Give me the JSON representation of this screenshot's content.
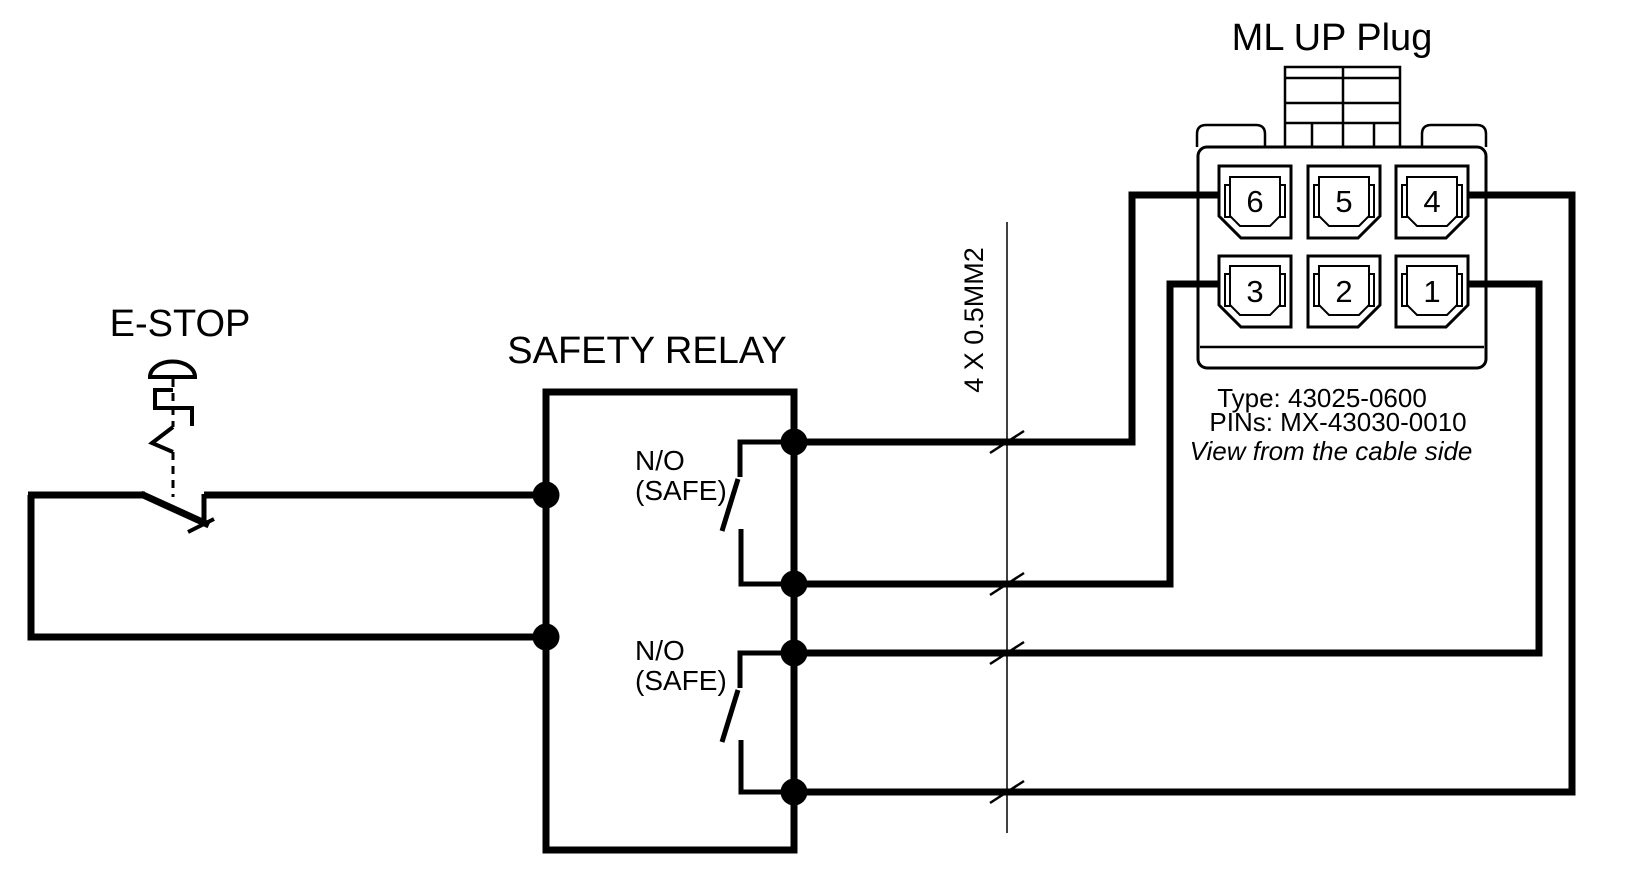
{
  "estop": {
    "label": "E-STOP"
  },
  "relay": {
    "label": "SAFETY RELAY",
    "contact1": {
      "line1": "N/O",
      "line2": "(SAFE)"
    },
    "contact2": {
      "line1": "N/O",
      "line2": "(SAFE)"
    }
  },
  "cable": {
    "label": "4 X 0.5MM2"
  },
  "connector": {
    "title": "ML UP Plug",
    "pins": [
      {
        "number": "6"
      },
      {
        "number": "5"
      },
      {
        "number": "4"
      },
      {
        "number": "3"
      },
      {
        "number": "2"
      },
      {
        "number": "1"
      }
    ],
    "type_line": "Type: 43025-0600",
    "pins_line": "PINs: MX-43030-0010",
    "view_line": "View from the cable side"
  },
  "colors": {
    "line": "#000000",
    "background": "#ffffff"
  }
}
